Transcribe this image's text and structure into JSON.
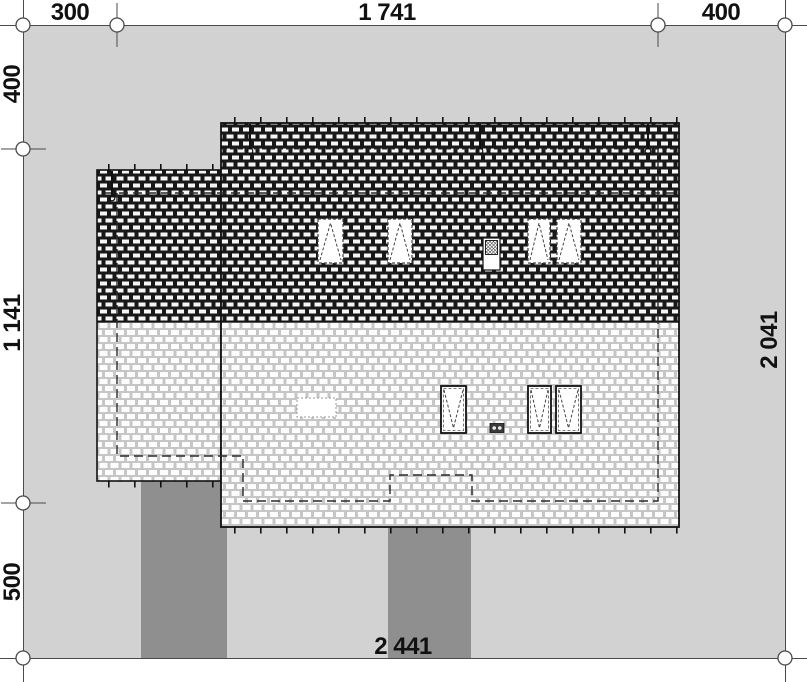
{
  "dimensions": {
    "top": [
      "300",
      "1 741",
      "400"
    ],
    "left": [
      "400",
      "1 141",
      "500"
    ],
    "right": "2 041",
    "bottom": "2 441"
  },
  "colors": {
    "page_background": "#ffffff",
    "plot_fill": "#d2d2d2",
    "paving_fill": "#8f8f8f",
    "line_ink": "#1a1a1a",
    "dimension_line": "#4a4a4a",
    "roof_dark_mortar": "#181818",
    "roof_light_mortar": "#c6c6c6",
    "roof_tile": "#ffffff"
  }
}
